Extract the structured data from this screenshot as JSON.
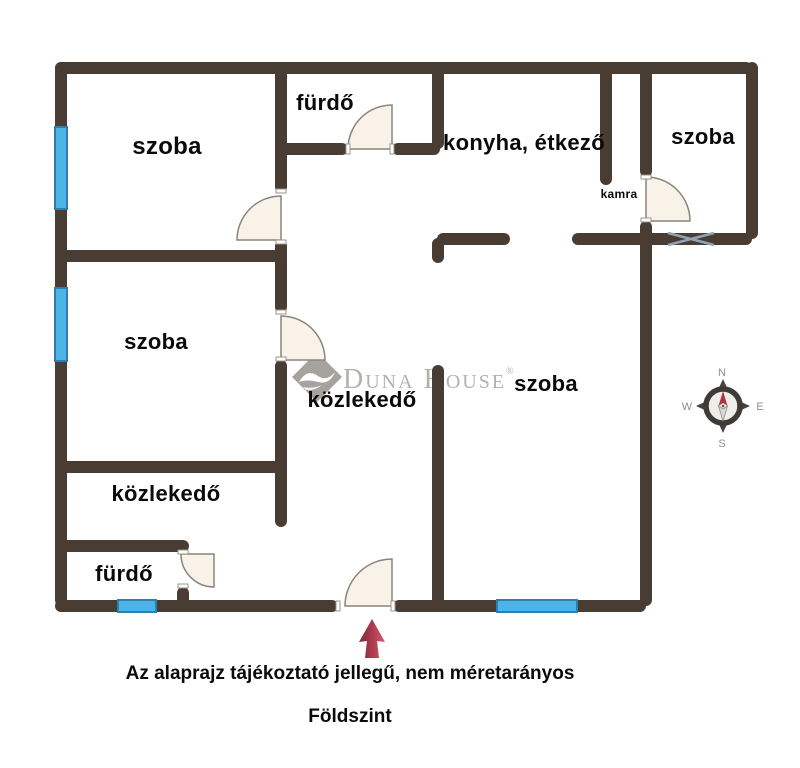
{
  "rooms": {
    "room_top_left": "szoba",
    "bathroom_top": "fürdő",
    "kitchen_dining": "konyha, étkező",
    "room_top_right": "szoba",
    "pantry": "kamra",
    "room_mid_left": "szoba",
    "hallway_center": "közlekedő",
    "room_bottom_right": "szoba",
    "hallway_left": "közlekedő",
    "bathroom_bottom": "fürdő"
  },
  "watermark": {
    "d1": "D",
    "rest1": "UNA",
    "d2": "H",
    "rest2": "OUSE",
    "registered": "®"
  },
  "compass": {
    "north": "N",
    "east": "E",
    "south": "S",
    "west": "W"
  },
  "captions": {
    "disclaimer": "Az alaprajz tájékoztató jellegű, nem méretarányos",
    "floor_level": "Földszint"
  },
  "colors": {
    "wall": "#493c33",
    "window_blue": "#4cb4e7",
    "window_border": "#2e7fae",
    "door_fill": "#f9f2e9",
    "arrow_red": "#c03a50",
    "watermark_gray": "#b5b2ae"
  }
}
